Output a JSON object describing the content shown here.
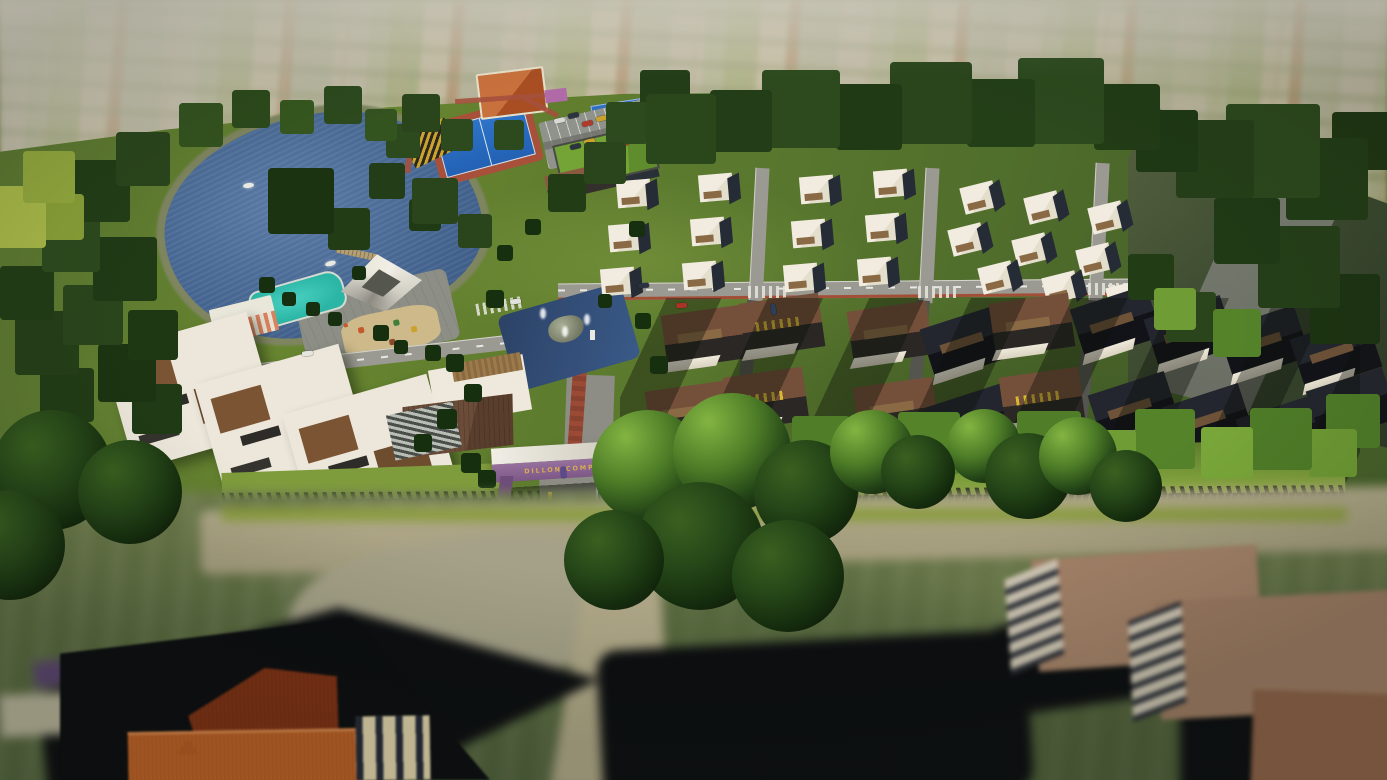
{
  "meta": {
    "title": "Dillon Complex aerial 3D render",
    "description": "Tilt-shift aerial architectural visualization of a gated residential complex surrounded by farmland"
  },
  "entrance_sign": {
    "text": "DILLON COMPLEX",
    "text_color": "#d8ab52",
    "awning_color": "#8a6292"
  },
  "scene": {
    "background": "patchwork farmland fields, hazy and blurred",
    "lake": {
      "label": "lake",
      "water_color": "#44648f",
      "boats": 2,
      "dock": 1
    },
    "amenities": {
      "swimming_pool_color": "#2ab5a4",
      "pavilion": "white faceted-roof event pavilion",
      "cabana": "striped changing rooms",
      "playground": "sand lot with play equipment"
    },
    "sports": {
      "basketball_court_color": "#2e74c8",
      "running_track_color": "#a8503a",
      "tennis_court_color": "#2e6fc0",
      "bleachers": "yellow-black striped stands",
      "parking_cars": 10
    },
    "clubhouse": {
      "label": "green-roof clubhouse",
      "roof_color": "#74a436"
    },
    "housing": {
      "white_townhouses": 21,
      "brown_roof_houses": 18,
      "lakeside_villas": 3,
      "townhouse_wall_color": "#f1ecdf",
      "brown_roof_color": "#74503a"
    },
    "roads": {
      "asphalt_color": "#9b9a92",
      "bike_lane_color": "#a24f38",
      "roundabout_fountain": true
    },
    "boundary": {
      "fence": "dark perimeter fence",
      "tree_rows": "dense green perimeter trees"
    },
    "foreground": {
      "existing_houses": 4,
      "orange_roof_color": "#c4672a",
      "tan_roof_color": "#b08b70",
      "ground": "blurred grass, dirt roads and long tree shadows"
    }
  }
}
